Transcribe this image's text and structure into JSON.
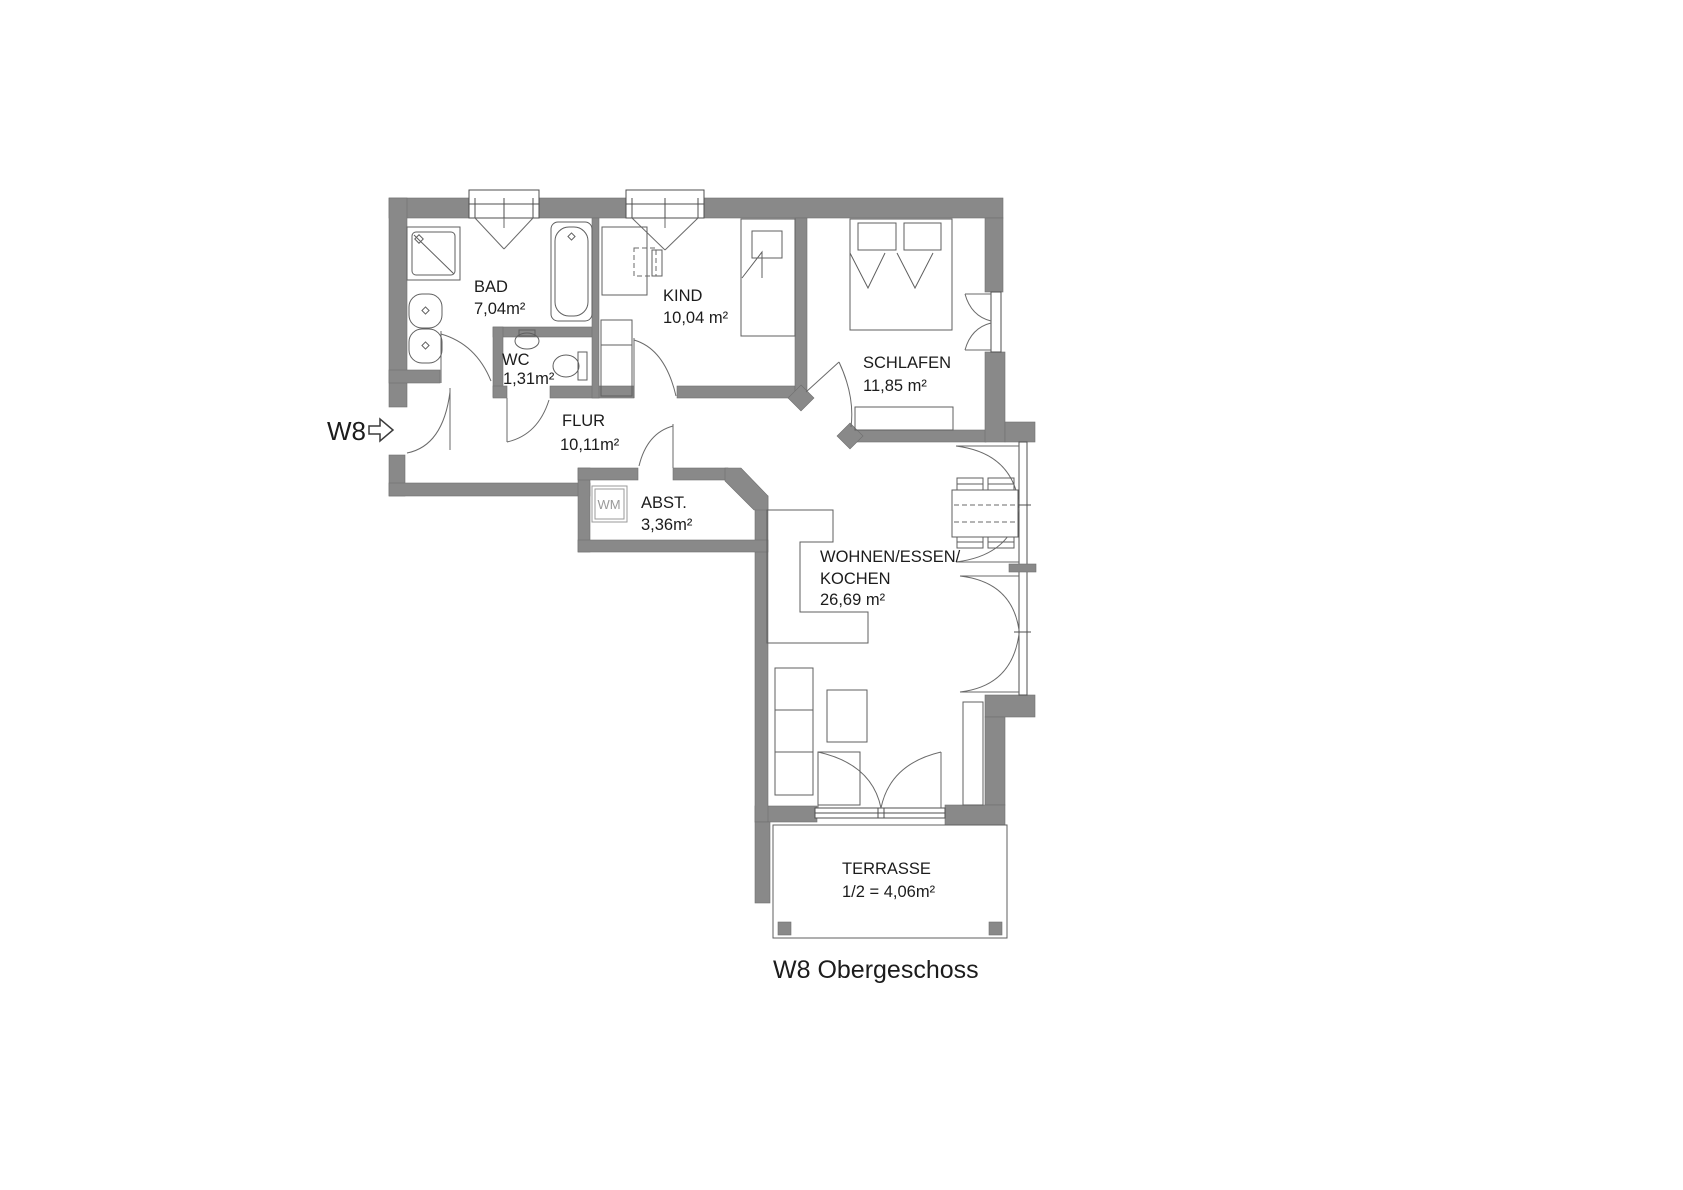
{
  "title": "W8 Obergeschoss",
  "entrance": {
    "label": "W8",
    "arrow_icon": "right-arrow"
  },
  "rooms": {
    "bad": {
      "name": "BAD",
      "area": "7,04m²"
    },
    "wc": {
      "name": "WC",
      "area": "1,31m²"
    },
    "kind": {
      "name": "KIND",
      "area": "10,04 m²"
    },
    "schlafen": {
      "name": "SCHLAFEN",
      "area": "11,85 m²"
    },
    "flur": {
      "name": "FLUR",
      "area": "10,11m²"
    },
    "abst": {
      "name": "ABST.",
      "area": "3,36m²"
    },
    "wohnen": {
      "name_line1": "WOHNEN/ESSEN/",
      "name_line2": "KOCHEN",
      "area": "26,69 m²"
    },
    "terrasse": {
      "name": "TERRASSE",
      "area": "1/2 = 4,06m²"
    }
  },
  "appliances": {
    "washing_machine_label": "WM"
  },
  "colors": {
    "wall": "#898989",
    "line": "#4f4f4f",
    "text": "#1c1c1c"
  }
}
